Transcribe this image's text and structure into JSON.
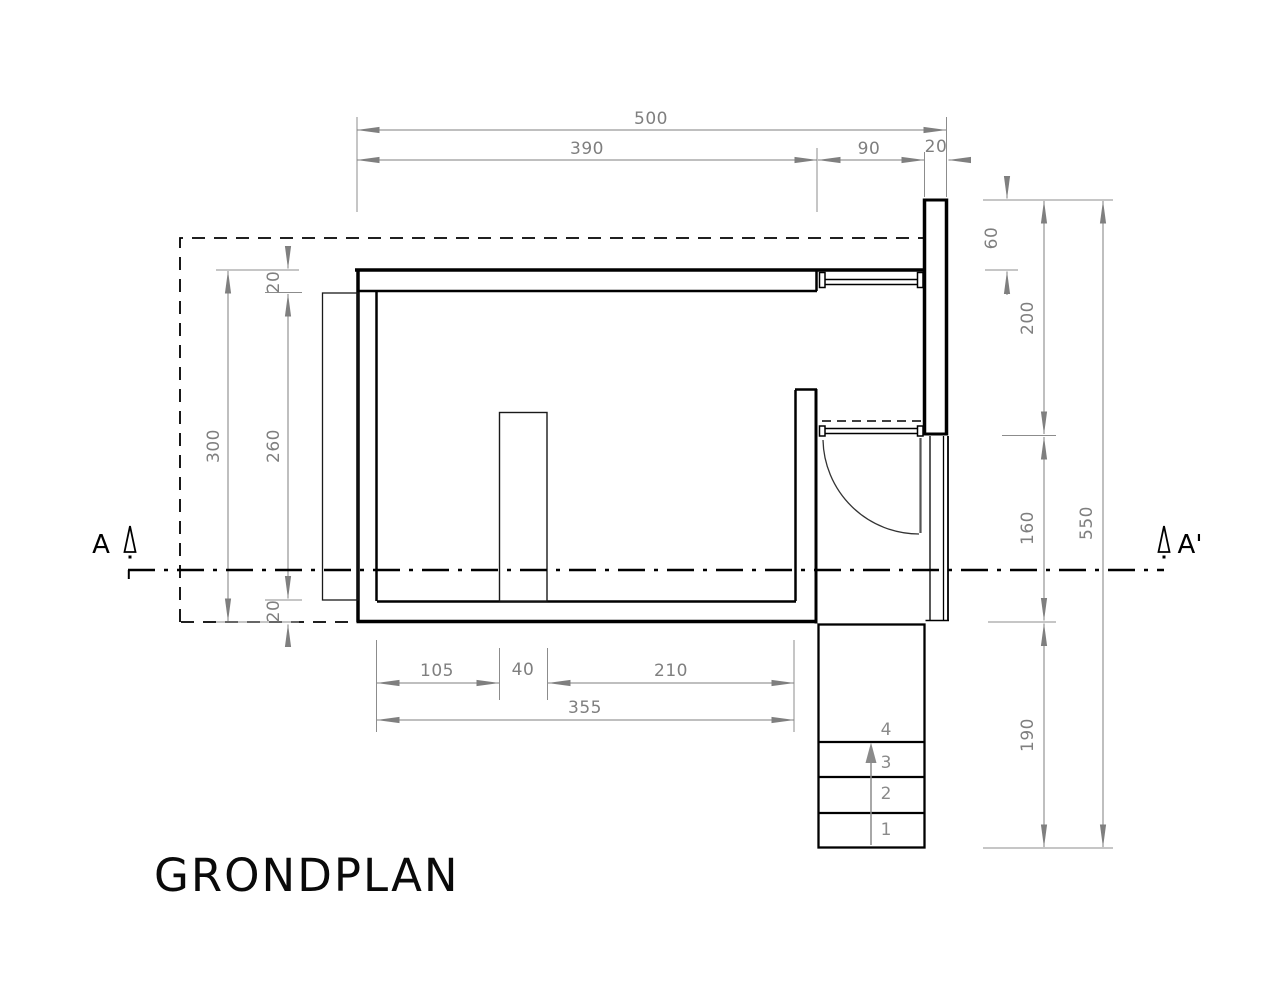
{
  "drawing": {
    "title": "GRONDPLAN",
    "section_label_left": "A",
    "section_label_right": "A'"
  },
  "dims": {
    "top": [
      "500",
      "390",
      "90",
      "20"
    ],
    "left": [
      "20",
      "300",
      "260",
      "20"
    ],
    "right": [
      "60",
      "200",
      "160",
      "550",
      "190"
    ],
    "bottom": [
      "105",
      "40",
      "210",
      "355"
    ]
  },
  "stairs": {
    "treads": [
      "4",
      "3",
      "2",
      "1"
    ]
  },
  "colors": {
    "line": "#000000",
    "dim": "#7f7f7f",
    "background": "#ffffff"
  }
}
